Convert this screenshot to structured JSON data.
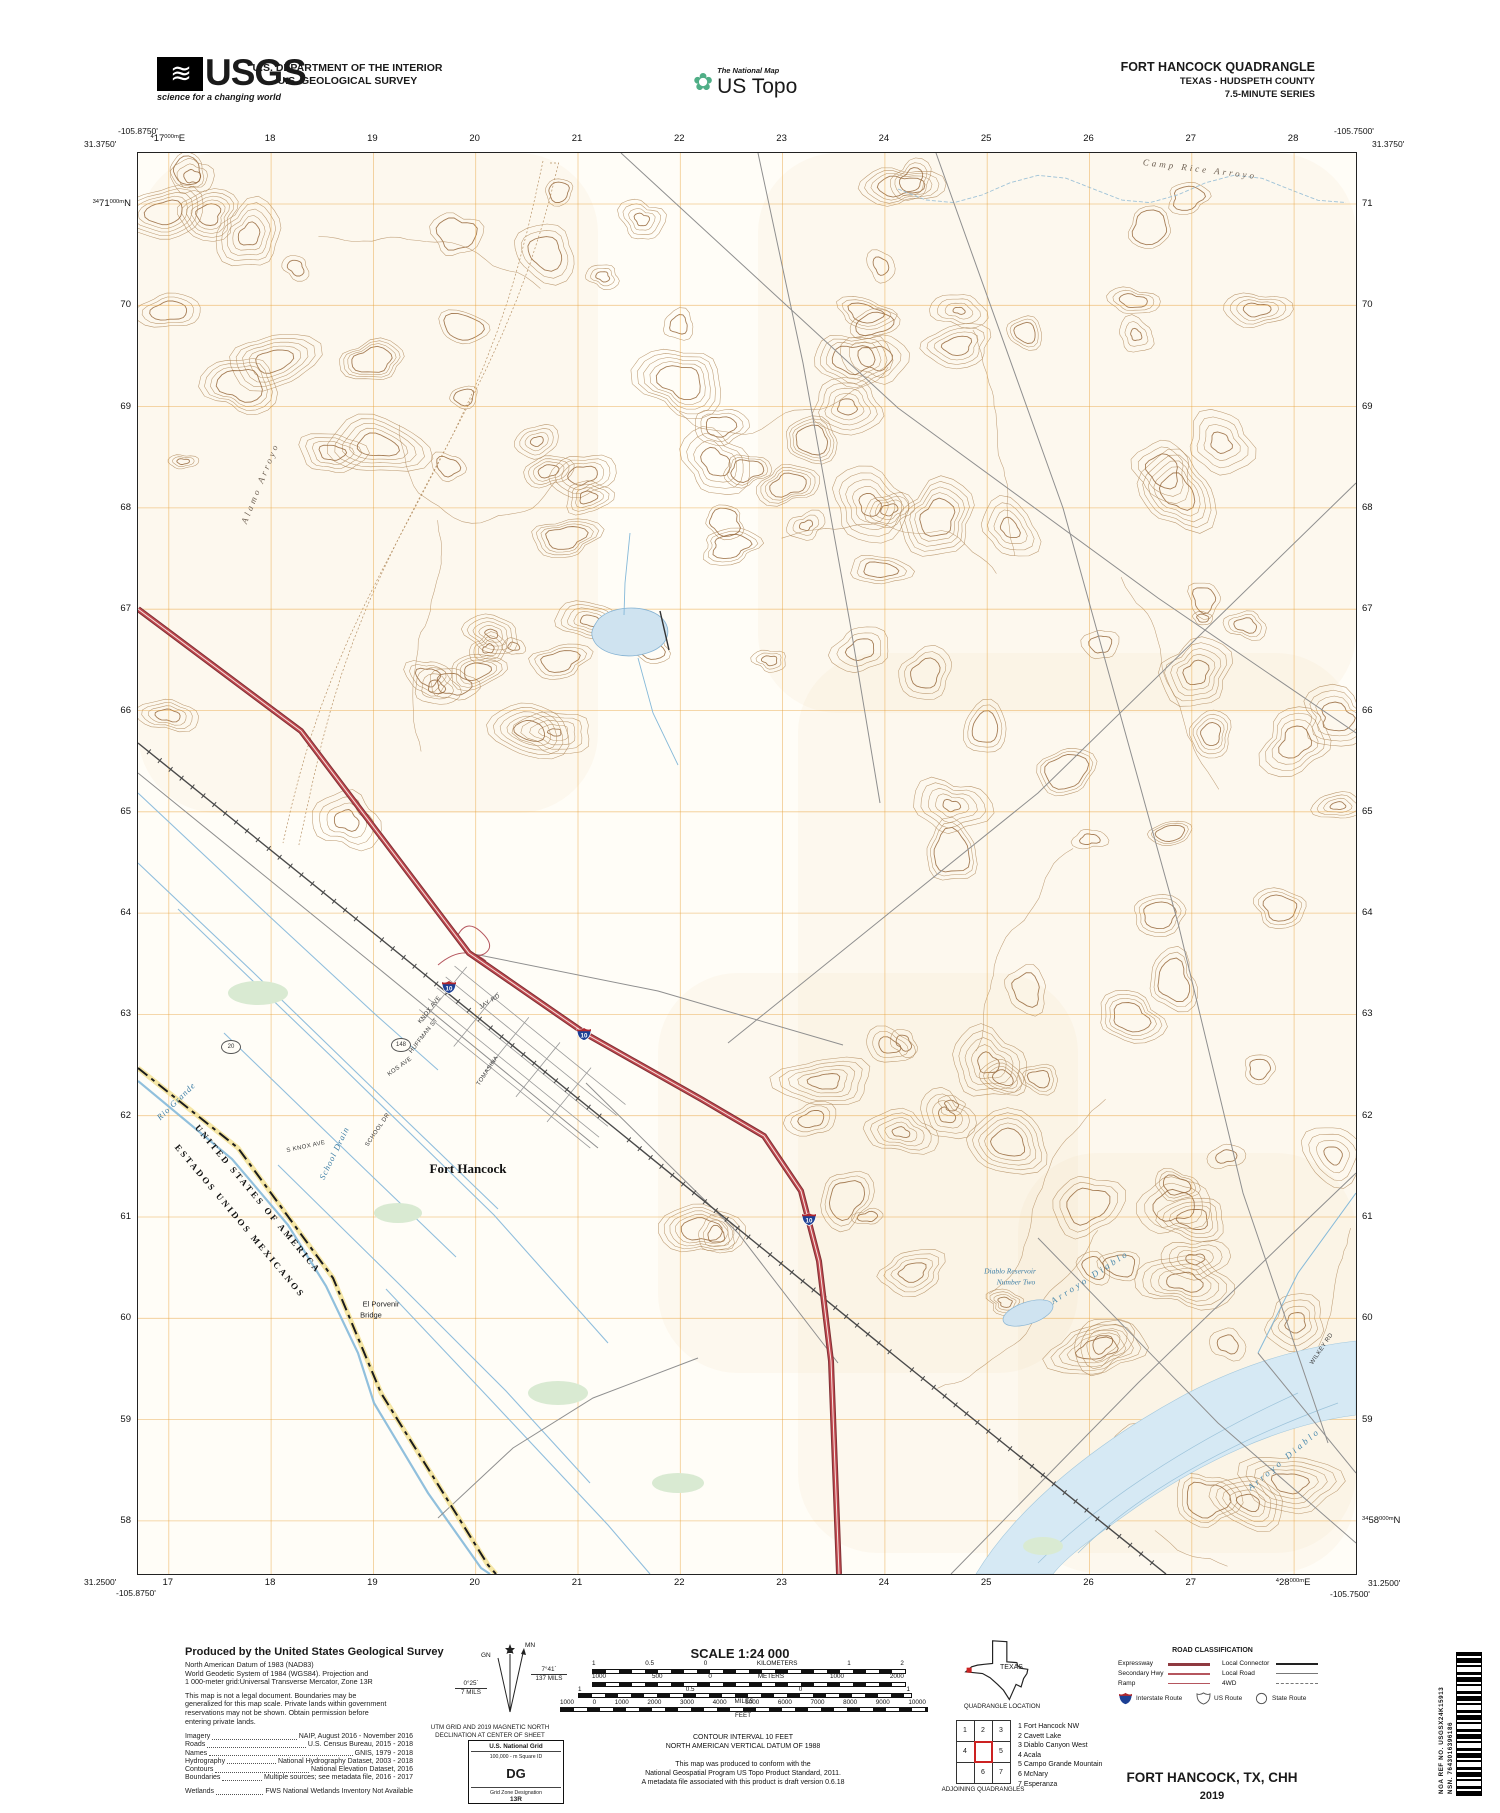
{
  "colors": {
    "contour": "#b0895c",
    "contour_index": "#96683c",
    "grid": "#e8a33d",
    "water_line": "#85b9d9",
    "water_fill": "#d6e9f4",
    "interstate_red": "#c0484f",
    "shield_blue": "#1c3f94",
    "legend_red": "#a03c42"
  },
  "header": {
    "usgs_logo": {
      "text": "USGS",
      "tagline": "science for a changing world"
    },
    "department_line1": "U.S. DEPARTMENT OF THE INTERIOR",
    "department_line2": "U.S. GEOLOGICAL SURVEY",
    "ustopo": {
      "small": "The National Map",
      "big": "US Topo"
    },
    "quad_title": "FORT HANCOCK QUADRANGLE",
    "quad_subtitle": "TEXAS - HUDSPETH COUNTY",
    "quad_series": "7.5-MINUTE SERIES"
  },
  "map": {
    "corners": {
      "tl_lon": "-105.8750'",
      "tl_lat": "31.3750'",
      "tr_lon": "-105.7500'",
      "tr_lat": "31.3750'",
      "bl_lat": "31.2500'",
      "bl_lon": "-105.8750'",
      "br_lat": "31.2500'",
      "br_lon": "-105.7500'"
    },
    "grid": {
      "eastings": [
        "17",
        "18",
        "19",
        "20",
        "21",
        "22",
        "23",
        "24",
        "25",
        "26",
        "27",
        "28"
      ],
      "easting_prefix": "4",
      "easting_suffix": "000m",
      "easting_dir": "E",
      "northings": [
        "71",
        "70",
        "69",
        "68",
        "67",
        "66",
        "65",
        "64",
        "63",
        "62",
        "61",
        "60",
        "59",
        "58"
      ],
      "northing_prefix": "34",
      "northing_suffix": "000m",
      "northing_dir": "N"
    },
    "labels": [
      {
        "text": "Camp Rice Arroyo",
        "x": 1062,
        "y": 16,
        "rot": 7,
        "cls": "arroyo"
      },
      {
        "text": "Alamo Arroyo",
        "x": 122,
        "y": 330,
        "rot": -68,
        "cls": "arroyo"
      },
      {
        "text": "Arroyo Diablo",
        "x": 952,
        "y": 1124,
        "rot": -33,
        "cls": "arroyo-blue"
      },
      {
        "text": "Arroyo Diablo",
        "x": 1146,
        "y": 1306,
        "rot": -40,
        "cls": "arroyo-blue"
      },
      {
        "text": "Diablo Reservoir",
        "x": 872,
        "y": 1118,
        "rot": 0,
        "cls": "water-name"
      },
      {
        "text": "Number Two",
        "x": 878,
        "y": 1129,
        "rot": 0,
        "cls": "water-name"
      },
      {
        "text": "Fort Hancock",
        "x": 330,
        "y": 1016,
        "rot": 0,
        "cls": "town"
      },
      {
        "text": "El Porvenir",
        "x": 243,
        "y": 1151,
        "rot": 0,
        "cls": "feature"
      },
      {
        "text": "Bridge",
        "x": 233,
        "y": 1162,
        "rot": 0,
        "cls": "feature"
      },
      {
        "text": "Rio Grande",
        "x": 38,
        "y": 948,
        "rot": -44,
        "cls": "water-ital"
      },
      {
        "text": "School Drain",
        "x": 196,
        "y": 1000,
        "rot": -64,
        "cls": "water-ital"
      },
      {
        "text": "UNITED STATES OF AMERICA",
        "x": 120,
        "y": 1046,
        "rot": 50,
        "cls": "border-name"
      },
      {
        "text": "ESTADOS UNIDOS MEXICANOS",
        "x": 102,
        "y": 1068,
        "rot": 50,
        "cls": "border-name"
      },
      {
        "text": "WILKEY RD",
        "x": 1184,
        "y": 1196,
        "rot": -56,
        "cls": "roadname"
      },
      {
        "text": "JAY RD",
        "x": 352,
        "y": 849,
        "rot": -32,
        "cls": "roadname"
      },
      {
        "text": "KNOX AVE",
        "x": 292,
        "y": 857,
        "rot": -52,
        "cls": "roadname"
      },
      {
        "text": "HUFFMAN ST",
        "x": 286,
        "y": 883,
        "rot": -52,
        "cls": "roadname"
      },
      {
        "text": "KOS AVE",
        "x": 262,
        "y": 914,
        "rot": -36,
        "cls": "roadname"
      },
      {
        "text": "TOMASINA",
        "x": 350,
        "y": 918,
        "rot": -56,
        "cls": "roadname"
      },
      {
        "text": "S KNOX AVE",
        "x": 168,
        "y": 994,
        "rot": -12,
        "cls": "roadname"
      },
      {
        "text": "SCHOOL DR",
        "x": 240,
        "y": 977,
        "rot": -56,
        "cls": "roadname"
      }
    ],
    "shields": [
      {
        "num": "10",
        "x": 311,
        "y": 834
      },
      {
        "num": "10",
        "x": 446,
        "y": 881
      },
      {
        "num": "10",
        "x": 671,
        "y": 1066
      }
    ],
    "route_circles": [
      {
        "num": "148",
        "x": 263,
        "y": 892
      },
      {
        "num": "20",
        "x": 93,
        "y": 894
      }
    ]
  },
  "footer": {
    "producer": {
      "title": "Produced by the United States Geological Survey",
      "datum_lines": [
        "North American Datum of 1983 (NAD83)",
        "World Geodetic System of 1984 (WGS84).  Projection and",
        "1 000-meter grid:Universal Transverse Mercator, Zone 13R"
      ],
      "legal_lines": [
        "This map is not a legal document. Boundaries may be",
        "generalized for this map scale. Private lands within government",
        "reservations may not be shown. Obtain permission before",
        "entering private lands."
      ],
      "sources": [
        {
          "label": "Imagery",
          "value": "NAIP, August 2016 - November 2016"
        },
        {
          "label": "Roads",
          "value": "U.S. Census Bureau, 2015 - 2018"
        },
        {
          "label": "Names",
          "value": "GNIS, 1979 - 2018"
        },
        {
          "label": "Hydrography",
          "value": "National Hydrography Dataset, 2003 - 2018"
        },
        {
          "label": "Contours",
          "value": "National Elevation Dataset, 2016"
        },
        {
          "label": "Boundaries",
          "value": "Multiple sources; see metadata file, 2016 - 2017"
        },
        {
          "label": "Wetlands",
          "value": "FWS National Wetlands Inventory Not Available"
        }
      ]
    },
    "declination": {
      "mn": "MN",
      "gn": "GN",
      "right_deg": "7°41´",
      "right_mils": "137 MILS",
      "left_deg": "0°25´",
      "left_mils": "7 MILS",
      "caption1": "UTM GRID AND 2019 MAGNETIC NORTH",
      "caption2": "DECLINATION AT CENTER OF SHEET"
    },
    "usng": {
      "title": "U.S. National Grid",
      "sub": "100,000 - m Square ID",
      "square": "DG",
      "zone_label": "Grid Zone Designation",
      "zone": "13R"
    },
    "scale": {
      "title": "SCALE 1:24 000",
      "km": {
        "labels": [
          "1",
          "0.5",
          "0",
          "KILOMETERS",
          "1",
          "2"
        ]
      },
      "m": {
        "labels": [
          "1000",
          "500",
          "0",
          "METERS",
          "1000",
          "2000"
        ]
      },
      "mi": {
        "labels": [
          "1",
          "0.5",
          "0",
          "1"
        ],
        "word": "MILES"
      },
      "ft": {
        "labels": [
          "1000",
          "0",
          "1000",
          "2000",
          "3000",
          "4000",
          "5000",
          "6000",
          "7000",
          "8000",
          "9000",
          "10000"
        ],
        "word": "FEET"
      }
    },
    "notes": {
      "contour1": "CONTOUR INTERVAL 10 FEET",
      "contour2": "NORTH AMERICAN VERTICAL DATUM OF 1988",
      "conform": [
        "This map was produced to conform with the",
        "National Geospatial Program US Topo Product Standard, 2011.",
        "A metadata file associated with this product is draft version 0.6.18"
      ]
    },
    "location": {
      "state": "TEXAS",
      "caption": "QUADRANGLE LOCATION"
    },
    "adjoining": {
      "cells": [
        [
          "1",
          "2",
          "3"
        ],
        [
          "4",
          "",
          "5"
        ],
        [
          "",
          "6",
          "7"
        ]
      ],
      "names": [
        "1 Fort Hancock NW",
        "2 Cavett Lake",
        "3 Diablo Canyon West",
        "4 Acala",
        "5 Campo Grande Mountain",
        "6 McNary",
        "7 Esperanza"
      ],
      "caption": "ADJOINING QUADRANGLES"
    },
    "roadclass": {
      "title": "ROAD CLASSIFICATION",
      "left": [
        {
          "label": "Expressway",
          "style": "expressway"
        },
        {
          "label": "Secondary Hwy",
          "style": "secondary"
        },
        {
          "label": "Ramp",
          "style": "ramp"
        }
      ],
      "right": [
        {
          "label": "Local Connector",
          "style": "connector"
        },
        {
          "label": "Local Road",
          "style": "local"
        },
        {
          "label": "4WD",
          "style": "fourwd"
        }
      ],
      "shields": [
        {
          "type": "interstate",
          "label": "Interstate Route"
        },
        {
          "type": "us",
          "label": "US Route"
        },
        {
          "type": "state",
          "label": "State Route"
        }
      ]
    },
    "sheet": {
      "name": "FORT HANCOCK,  TX, CHH",
      "year": "2019"
    },
    "barcode": {
      "nsn_label": "NSN.",
      "nsn": "7643016396186",
      "nga_label": "NGA REF NO.",
      "nga": "USGSX24K15913"
    }
  }
}
